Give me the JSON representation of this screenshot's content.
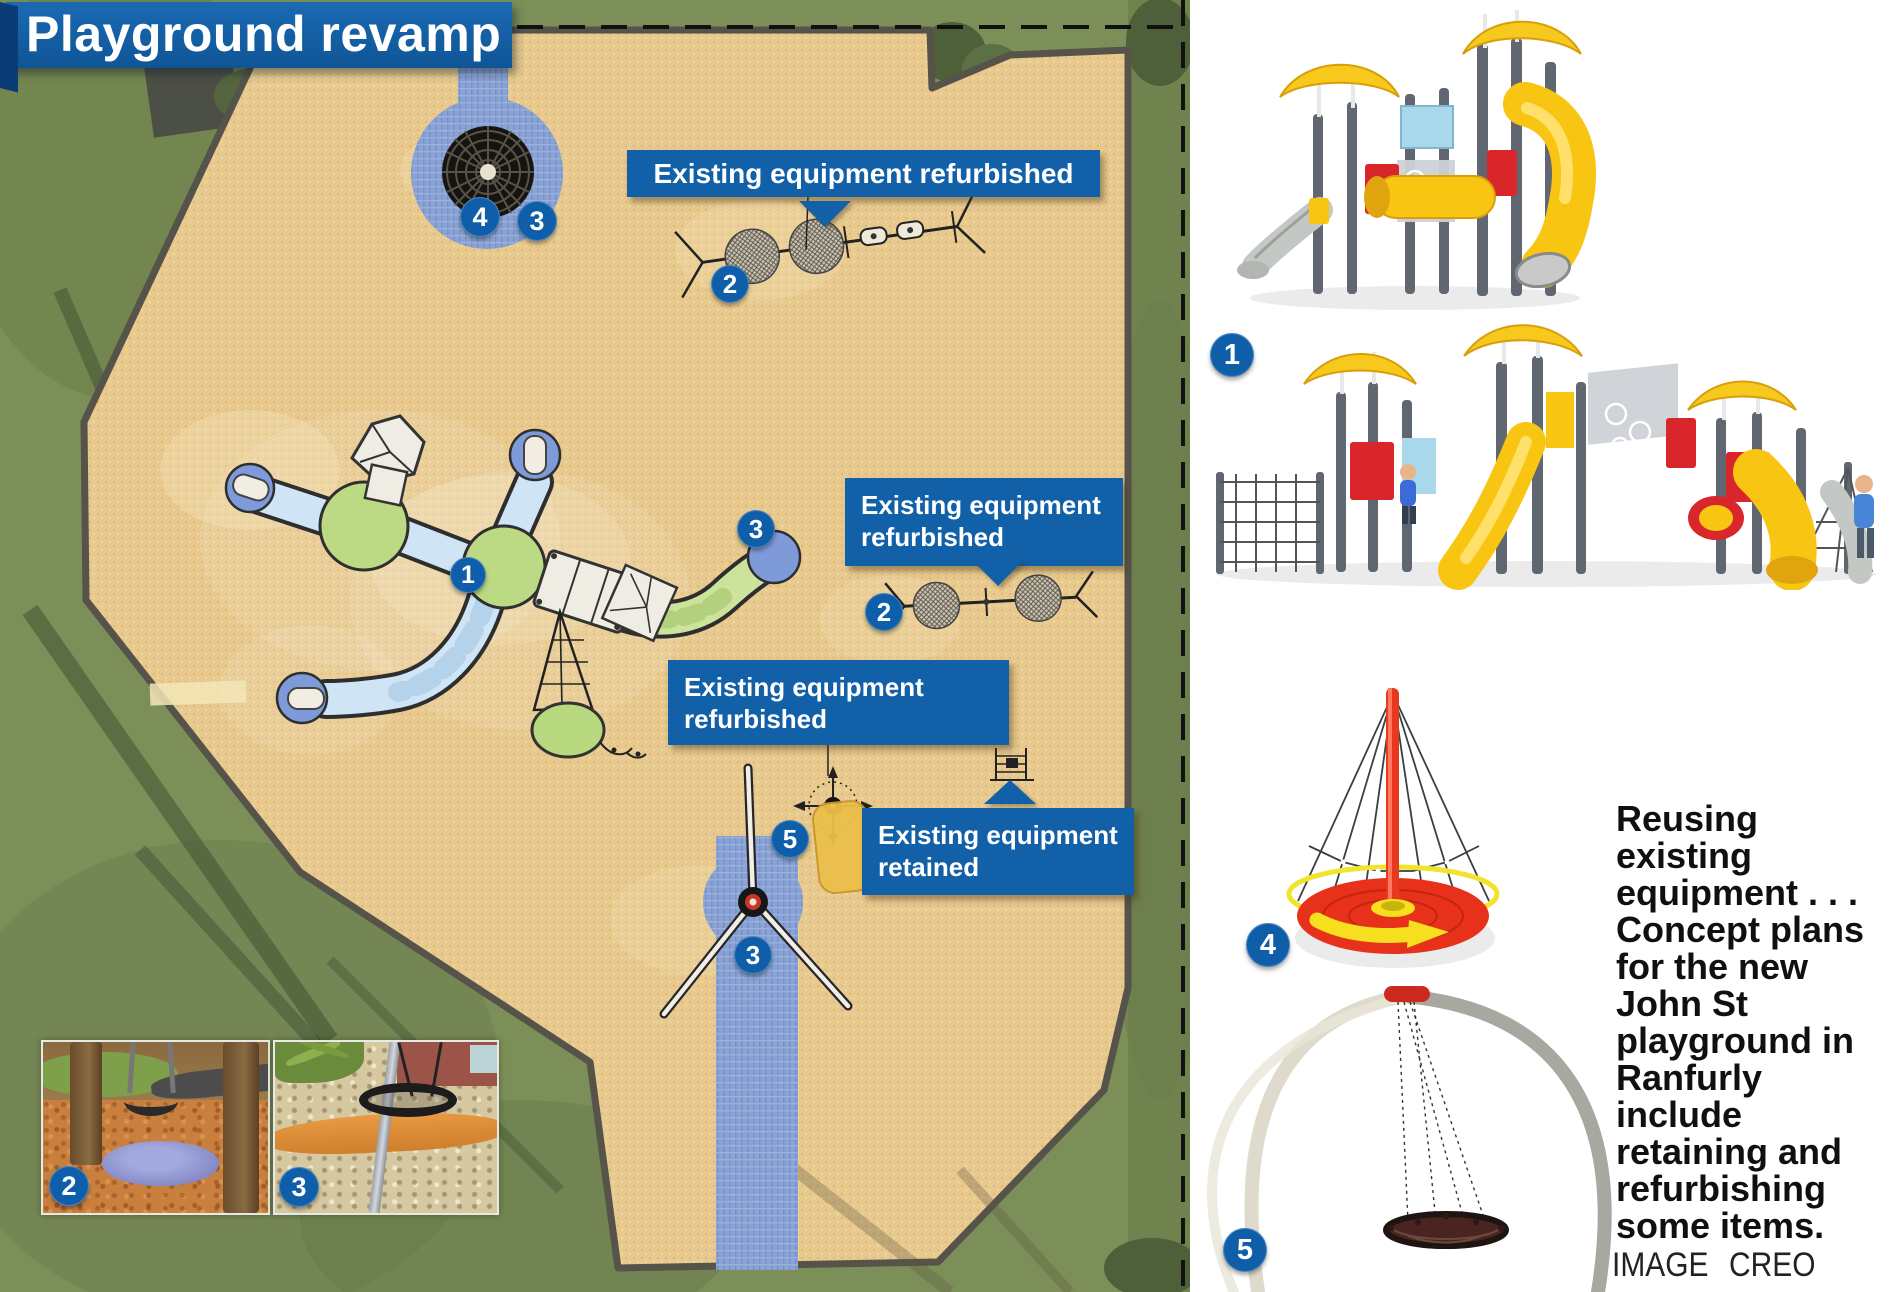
{
  "title": "Playground revamp",
  "map": {
    "label_top": "Existing equipment refurbished",
    "label_right": {
      "line1": "Existing equipment",
      "line2": "refurbished"
    },
    "label_mid": {
      "line1": "Existing equipment",
      "line2": "refurbished"
    },
    "label_retained": {
      "line1": "Existing equipment",
      "line2": "retained"
    }
  },
  "badges": {
    "n1": "1",
    "n2": "2",
    "n3": "3",
    "n4": "4",
    "n5": "5"
  },
  "caption": {
    "text": "Reusing existing equipment . . . Concept plans for the new John St playground in Ranfurly include retaining and refurbishing some items.",
    "credit": "IMAGE CREO"
  },
  "colors": {
    "label_blue": "#1160a8",
    "sand": "#e8c98e",
    "grass": "#7c8f58",
    "tube_blue": "#cfe4f4",
    "platform_green": "#bcda83",
    "roof_yellow": "#f7c81e",
    "equipment_red": "#d8262a",
    "spinner_red": "#e8311a"
  }
}
